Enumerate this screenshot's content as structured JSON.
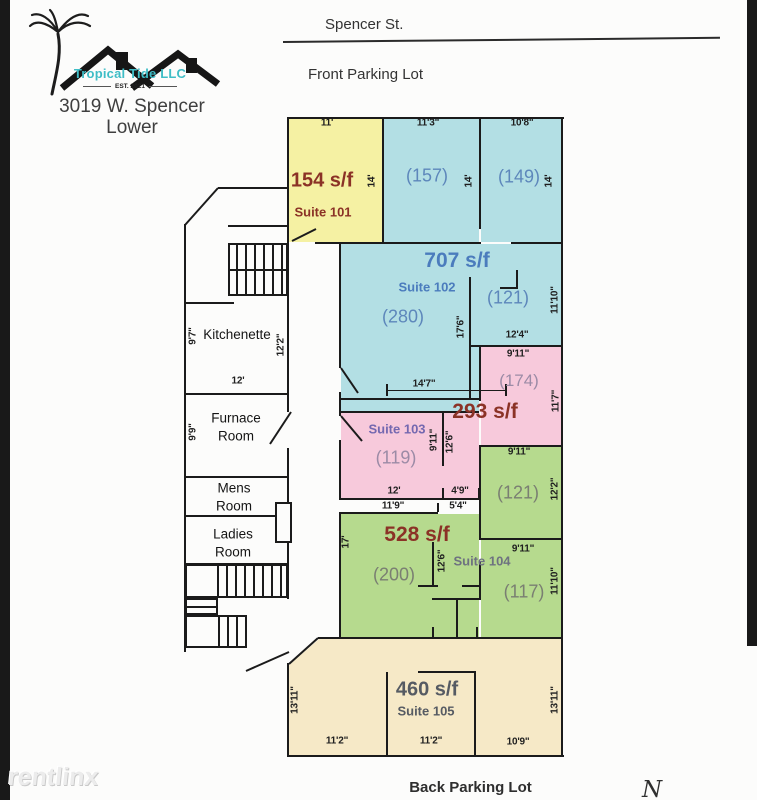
{
  "header": {
    "street_label": "Spencer St.",
    "front_lot_label": "Front Parking Lot"
  },
  "logo": {
    "company": "Tropical Tide LLC",
    "established": "EST. 2021",
    "address_line1": "3019 W. Spencer",
    "address_line2": "Lower"
  },
  "footer": {
    "back_lot_label": "Back Parking Lot",
    "compass": "N",
    "watermark": "rentlinx"
  },
  "suites": {
    "s101": {
      "sqft": "154 s/f",
      "name": "Suite 101"
    },
    "s102": {
      "sqft": "707 s/f",
      "name": "Suite 102",
      "room_main": "(280)",
      "room_a": "(157)",
      "room_b": "(149)",
      "room_c": "(121)"
    },
    "s103": {
      "sqft": "293 s/f",
      "name": "Suite 103",
      "room_main": "(119)",
      "room_a": "(174)"
    },
    "s104": {
      "sqft": "528 s/f",
      "name": "Suite 104",
      "room_main": "(200)",
      "room_a": "(121)",
      "room_b": "(117)"
    },
    "s105": {
      "sqft": "460 s/f",
      "name": "Suite 105"
    }
  },
  "rooms": {
    "kitchenette": "Kitchenette",
    "furnace": "Furnace Room",
    "mens": "Mens Room",
    "ladies": "Ladies Room"
  },
  "dims": [
    {
      "t": "11'",
      "x": 327,
      "y": 123,
      "r": 0
    },
    {
      "t": "11'3\"",
      "x": 428,
      "y": 123,
      "r": 0
    },
    {
      "t": "10'8\"",
      "x": 522,
      "y": 123,
      "r": 0
    },
    {
      "t": "14'",
      "x": 372,
      "y": 181,
      "r": 1
    },
    {
      "t": "14'",
      "x": 469,
      "y": 181,
      "r": 1
    },
    {
      "t": "14'",
      "x": 549,
      "y": 181,
      "r": 1
    },
    {
      "t": "11'10\"",
      "x": 555,
      "y": 300,
      "r": 1
    },
    {
      "t": "17'6\"",
      "x": 461,
      "y": 327,
      "r": 1
    },
    {
      "t": "12'4\"",
      "x": 517,
      "y": 335,
      "r": 0
    },
    {
      "t": "9'11\"",
      "x": 518,
      "y": 354,
      "r": 0
    },
    {
      "t": "14'7\"",
      "x": 424,
      "y": 384,
      "r": 0
    },
    {
      "t": "11'7\"",
      "x": 556,
      "y": 401,
      "r": 1
    },
    {
      "t": "9'11\"",
      "x": 434,
      "y": 440,
      "r": 1
    },
    {
      "t": "12'6\"",
      "x": 450,
      "y": 442,
      "r": 1
    },
    {
      "t": "12'",
      "x": 394,
      "y": 491,
      "r": 0
    },
    {
      "t": "4'9\"",
      "x": 460,
      "y": 491,
      "r": 0
    },
    {
      "t": "11'9\"",
      "x": 393,
      "y": 506,
      "r": 0
    },
    {
      "t": "5'4\"",
      "x": 458,
      "y": 506,
      "r": 0
    },
    {
      "t": "9'11\"",
      "x": 519,
      "y": 452,
      "r": 0
    },
    {
      "t": "12'2\"",
      "x": 555,
      "y": 489,
      "r": 1
    },
    {
      "t": "17'",
      "x": 346,
      "y": 542,
      "r": 1
    },
    {
      "t": "12'6\"",
      "x": 442,
      "y": 561,
      "r": 1
    },
    {
      "t": "9'11\"",
      "x": 523,
      "y": 549,
      "r": 0
    },
    {
      "t": "11'10\"",
      "x": 555,
      "y": 581,
      "r": 1
    },
    {
      "t": "12'2\"",
      "x": 281,
      "y": 345,
      "r": 1
    },
    {
      "t": "9'7\"",
      "x": 193,
      "y": 336,
      "r": 1
    },
    {
      "t": "12'",
      "x": 238,
      "y": 381,
      "r": 0
    },
    {
      "t": "9'9\"",
      "x": 193,
      "y": 432,
      "r": 1
    },
    {
      "t": "13'11\"",
      "x": 295,
      "y": 700,
      "r": 1
    },
    {
      "t": "13'11\"",
      "x": 555,
      "y": 700,
      "r": 1
    },
    {
      "t": "11'2\"",
      "x": 337,
      "y": 741,
      "r": 0
    },
    {
      "t": "11'2\"",
      "x": 431,
      "y": 741,
      "r": 0
    },
    {
      "t": "10'9\"",
      "x": 518,
      "y": 742,
      "r": 0
    }
  ],
  "colors": {
    "suite101": "#f5f1a3",
    "suite102": "#b3dfe4",
    "suite103": "#f7c9db",
    "suite104": "#b6da8e",
    "suite105": "#f6e9c7",
    "wall": "#1b1b1b",
    "sqft_red": "#8b3226",
    "blue_label": "#4b7cbd",
    "purple_label": "#7468b0",
    "gray_label": "#6e7280",
    "slate_label": "#565b63",
    "logo_teal": "#3ebdc6",
    "scan_bar": "#191919",
    "watermark_gray": "#ececec"
  }
}
